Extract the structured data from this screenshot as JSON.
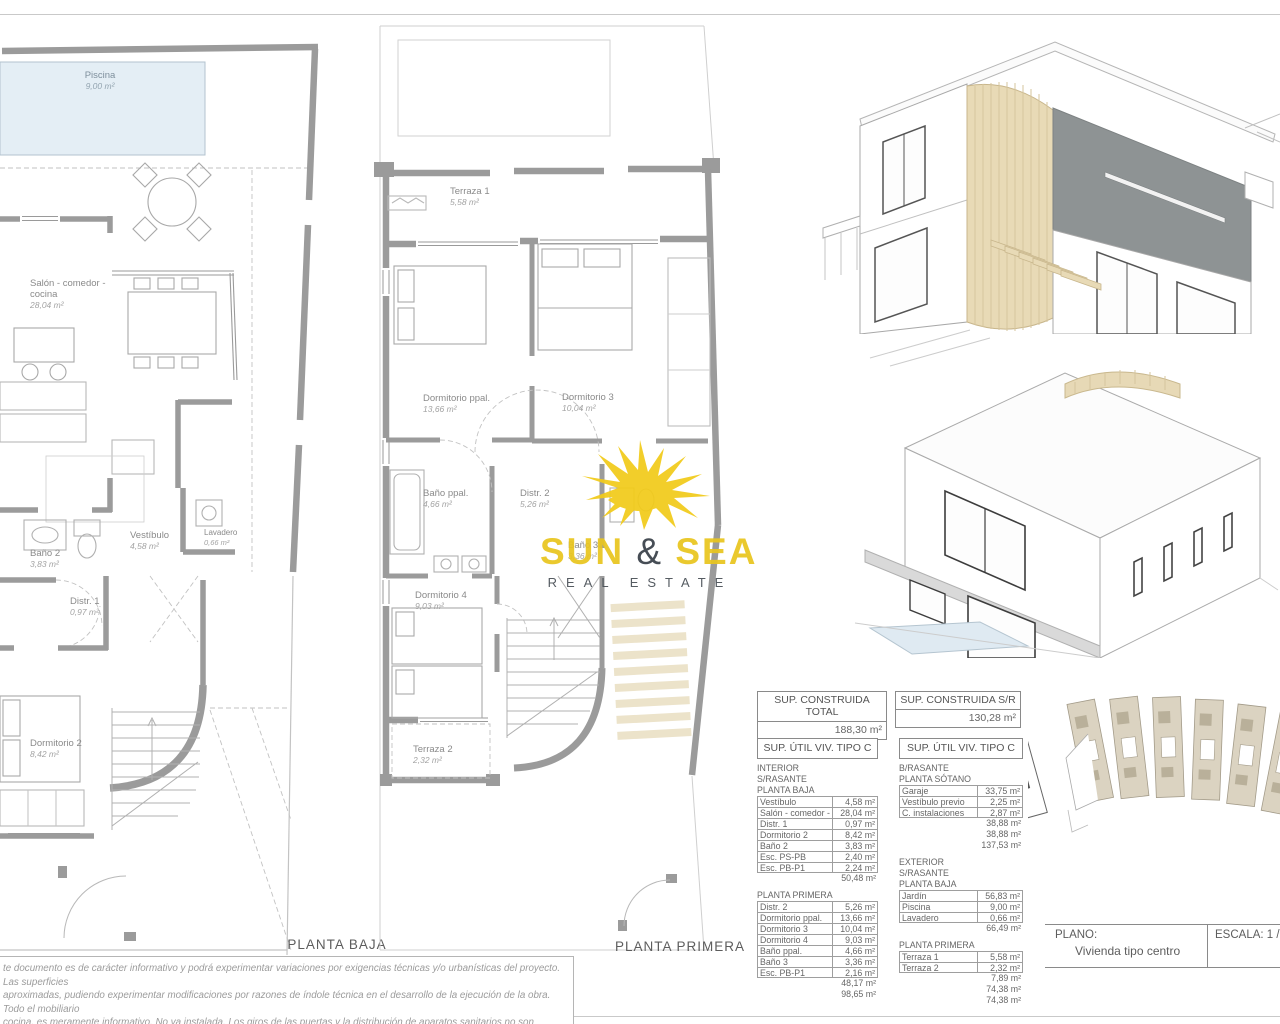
{
  "plans": {
    "baja": {
      "title": "PLANTA BAJA",
      "rooms": [
        {
          "n1": "Piscina",
          "area": "9,00 m²"
        },
        {
          "n1": "Salón - comedor -",
          "n2": "cocina",
          "area": "28,04 m²"
        },
        {
          "n1": "Vestíbulo",
          "area": "4,58 m²"
        },
        {
          "n1": "Lavadero",
          "area": "0,66 m²"
        },
        {
          "n1": "Baño 2",
          "area": "3,83 m²"
        },
        {
          "n1": "Distr. 1",
          "area": "0,97 m²"
        },
        {
          "n1": "Dormitorio 2",
          "area": "8,42 m²"
        }
      ]
    },
    "primera": {
      "title": "PLANTA PRIMERA",
      "rooms": [
        {
          "n1": "Terraza 1",
          "area": "5,58 m²"
        },
        {
          "n1": "Dormitorio ppal.",
          "area": "13,66 m²"
        },
        {
          "n1": "Dormitorio 3",
          "area": "10,04 m²"
        },
        {
          "n1": "Baño ppal.",
          "area": "4,66 m²"
        },
        {
          "n1": "Distr. 2",
          "area": "5,26 m²"
        },
        {
          "n1": "Baño 3",
          "area": "3,36 m²"
        },
        {
          "n1": "Dormitorio 4",
          "area": "9,03 m²"
        },
        {
          "n1": "Terraza 2",
          "area": "2,32 m²"
        }
      ]
    }
  },
  "tables": {
    "construida": [
      {
        "header": "SUP. CONSTRUIDA TOTAL",
        "value": "188,30 m²"
      },
      {
        "header": "SUP. CONSTRUIDA S/R",
        "value": "130,28 m²"
      }
    ],
    "util_left": {
      "header": "SUP. ÚTIL VIV. TIPO C",
      "blocks": [
        {
          "type": "label",
          "text": "INTERIOR"
        },
        {
          "type": "label",
          "text": "S/RASANTE"
        },
        {
          "type": "label",
          "text": "PLANTA BAJA"
        },
        {
          "type": "row",
          "name": "Vestíbulo",
          "value": "4,58 m²"
        },
        {
          "type": "row",
          "name": "Salón - comedor - cocina",
          "value": "28,04 m²"
        },
        {
          "type": "row",
          "name": "Distr. 1",
          "value": "0,97 m²"
        },
        {
          "type": "row",
          "name": "Dormitorio 2",
          "value": "8,42 m²"
        },
        {
          "type": "row",
          "name": "Baño 2",
          "value": "3,83 m²"
        },
        {
          "type": "row",
          "name": "Esc. PS-PB",
          "value": "2,40 m²"
        },
        {
          "type": "row",
          "name": "Esc. PB-P1",
          "value": "2,24 m²"
        },
        {
          "type": "sum",
          "value": "50,48 m²"
        },
        {
          "type": "gap"
        },
        {
          "type": "label",
          "text": "PLANTA PRIMERA"
        },
        {
          "type": "row",
          "name": "Distr. 2",
          "value": "5,26 m²"
        },
        {
          "type": "row",
          "name": "Dormitorio ppal.",
          "value": "13,66 m²"
        },
        {
          "type": "row",
          "name": "Dormitorio 3",
          "value": "10,04 m²"
        },
        {
          "type": "row",
          "name": "Dormitorio 4",
          "value": "9,03 m²"
        },
        {
          "type": "row",
          "name": "Baño ppal.",
          "value": "4,66 m²"
        },
        {
          "type": "row",
          "name": "Baño 3",
          "value": "3,36 m²"
        },
        {
          "type": "row",
          "name": "Esc. PB-P1",
          "value": "2,16 m²"
        },
        {
          "type": "sum",
          "value": "48,17 m²"
        },
        {
          "type": "sum",
          "value": "98,65 m²"
        }
      ]
    },
    "util_right": {
      "header": "SUP. ÚTIL VIV. TIPO C",
      "blocks": [
        {
          "type": "label",
          "text": "B/RASANTE"
        },
        {
          "type": "label",
          "text": "PLANTA SÓTANO"
        },
        {
          "type": "row",
          "name": "Garaje",
          "value": "33,75 m²"
        },
        {
          "type": "row",
          "name": "Vestíbulo previo",
          "value": "2,25 m²"
        },
        {
          "type": "row",
          "name": "C. instalaciones",
          "value": "2,87 m²"
        },
        {
          "type": "sum",
          "value": "38,88 m²"
        },
        {
          "type": "sum",
          "value": "38,88 m²"
        },
        {
          "type": "sum",
          "value": "137,53 m²"
        },
        {
          "type": "gap"
        },
        {
          "type": "label",
          "text": "EXTERIOR"
        },
        {
          "type": "label",
          "text": "S/RASANTE"
        },
        {
          "type": "label",
          "text": "PLANTA BAJA"
        },
        {
          "type": "row",
          "name": "Jardín",
          "value": "56,83 m²"
        },
        {
          "type": "row",
          "name": "Piscina",
          "value": "9,00 m²"
        },
        {
          "type": "row",
          "name": "Lavadero",
          "value": "0,66 m²"
        },
        {
          "type": "sum",
          "value": "66,49 m²"
        },
        {
          "type": "gap"
        },
        {
          "type": "label",
          "text": "PLANTA PRIMERA"
        },
        {
          "type": "row",
          "name": "Terraza 1",
          "value": "5,58 m²"
        },
        {
          "type": "row",
          "name": "Terraza 2",
          "value": "2,32 m²"
        },
        {
          "type": "sum",
          "value": "7,89 m²"
        },
        {
          "type": "sum",
          "value": "74,38 m²"
        },
        {
          "type": "sum",
          "value": "74,38 m²"
        }
      ]
    }
  },
  "titleblock": {
    "plano_label": "PLANO:",
    "plano_value": "Vivienda tipo centro",
    "escala": "ESCALA: 1 / 75"
  },
  "disclaimer": {
    "lines": [
      "te documento es de carácter informativo y podrá experimentar variaciones por exigencias técnicas y/o urbanísticas del proyecto. Las superficies",
      "aproximadas, pudiendo experimentar modificaciones por razones de índole técnica en el desarrollo de la ejecución de la obra. Todo el mobiliario",
      "cocina, es meramente informativo. No va instalada. Los giros de las puertas y la distribución de aparatos sanitarios no son vinculantes."
    ]
  },
  "logo": {
    "word1": "SUN",
    "amp": "&",
    "word2": "SEA",
    "subtitle": "REAL ESTATE"
  },
  "colors": {
    "wall_gray": "#9B9B9B",
    "pool_blue": "#E4EEF5",
    "wood_beige": "#E8DAB6",
    "step_cream": "#ECE3CA",
    "facade_dark": "#8E9394",
    "sun_yellow": "#F2CB1A",
    "logo_yellow": "#E9C51F",
    "logo_dark": "#394049",
    "plot_beige": "#DBD3C1"
  }
}
